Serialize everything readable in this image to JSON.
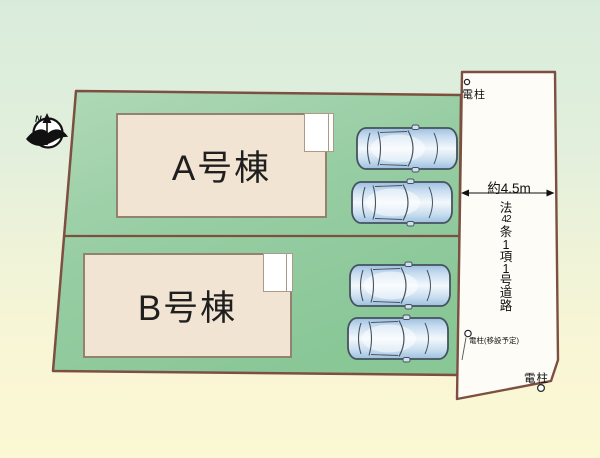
{
  "scene": {
    "compass": {
      "north_label": "N"
    },
    "buildings": [
      {
        "label": "A号棟"
      },
      {
        "label": "B号棟"
      }
    ],
    "road": {
      "width_label": "約4.5m",
      "designation_chars": [
        "法",
        "42",
        "条",
        "1",
        "項",
        "1",
        "号",
        "道",
        "路"
      ]
    },
    "poles": {
      "top_label": "電柱",
      "relocation_label": "電柱(移設予定)",
      "bottom_label": "電柱"
    },
    "colors": {
      "plot_green": "#9ccfa6",
      "boundary_brown": "#7d4f41",
      "building_fill": "#f1e4d3",
      "road_fill": "#fdfcf6",
      "car_blue": "#a9cbe8",
      "background_top": "#d9ecdc",
      "background_bottom": "#fbf8d4"
    }
  }
}
